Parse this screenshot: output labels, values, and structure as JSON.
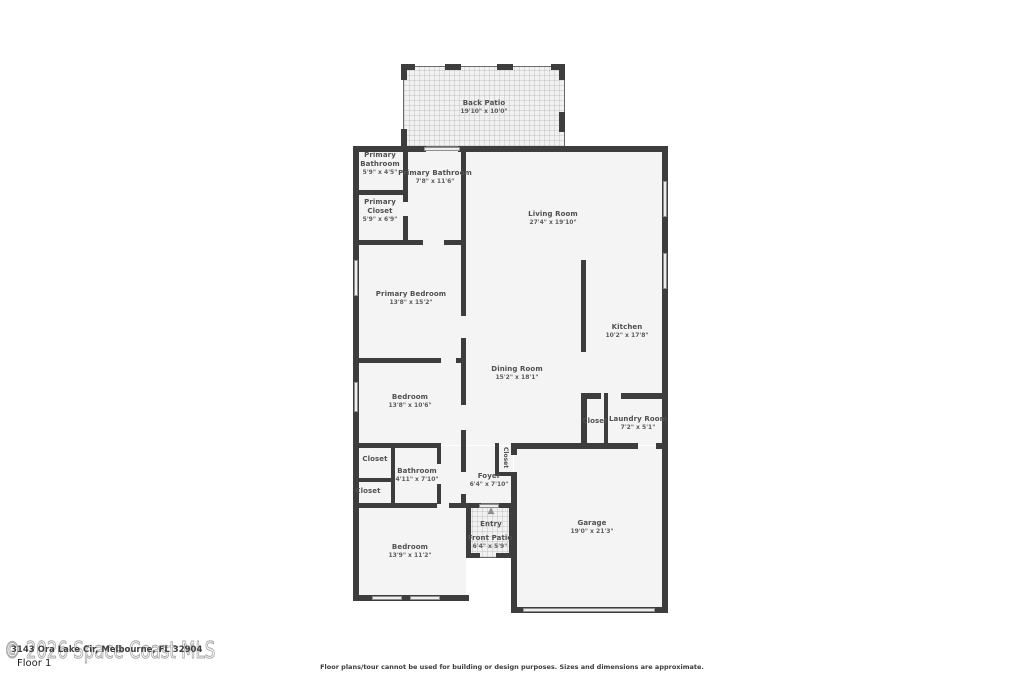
{
  "page": {
    "floor_label": "Floor 1",
    "watermark": "© 2026 Space Coast MLS",
    "address": "3143 Ora Lake Cir, Melbourne, FL 32904",
    "disclaimer": "Floor plans/tour cannot be used for building or design purposes. Sizes and dimensions are approximate."
  },
  "colors": {
    "wall": "#3d3d3d",
    "room_fill": "#f4f4f4",
    "label_text": "#4f4f4f",
    "watermark": "#a6a6a6"
  },
  "icons": {
    "entry_arrow": "▲"
  },
  "rooms": [
    {
      "id": "back-patio",
      "name": "Back Patio",
      "dims": "19'10\" x 10'0\""
    },
    {
      "id": "primary-bathroom-small",
      "name": "Primary Bathroom",
      "dims": "5'9\" x 4'5\""
    },
    {
      "id": "primary-bathroom",
      "name": "Primary Bathroom",
      "dims": "7'8\" x 11'6\""
    },
    {
      "id": "primary-closet",
      "name": "Primary Closet",
      "dims": "5'9\" x 6'9\""
    },
    {
      "id": "living-room",
      "name": "Living Room",
      "dims": "27'4\" x 19'10\""
    },
    {
      "id": "primary-bedroom",
      "name": "Primary Bedroom",
      "dims": "13'8\" x 15'2\""
    },
    {
      "id": "kitchen",
      "name": "Kitchen",
      "dims": "10'2\" x 17'8\""
    },
    {
      "id": "dining-room",
      "name": "Dining Room",
      "dims": "15'2\" x 18'1\""
    },
    {
      "id": "bedroom-2",
      "name": "Bedroom",
      "dims": "13'8\" x 10'6\""
    },
    {
      "id": "closet-laundry",
      "name": "Closet",
      "dims": ""
    },
    {
      "id": "laundry-room",
      "name": "Laundry Room",
      "dims": "7'2\" x 5'1\""
    },
    {
      "id": "closet-hall-top",
      "name": "Closet",
      "dims": ""
    },
    {
      "id": "bathroom",
      "name": "Bathroom",
      "dims": "4'11\" x 7'10\""
    },
    {
      "id": "closet-hall-bottom",
      "name": "Closet",
      "dims": ""
    },
    {
      "id": "foyer",
      "name": "Foyer",
      "dims": "6'4\" x 7'10\""
    },
    {
      "id": "closet-foyer",
      "name": "Closet",
      "dims": ""
    },
    {
      "id": "entry",
      "name": "Entry",
      "dims": ""
    },
    {
      "id": "front-patio",
      "name": "Front Patio",
      "dims": "6'4\" x 5'9\""
    },
    {
      "id": "bedroom-3",
      "name": "Bedroom",
      "dims": "13'9\" x 11'2\""
    },
    {
      "id": "garage",
      "name": "Garage",
      "dims": "19'0\" x 21'3\""
    }
  ]
}
